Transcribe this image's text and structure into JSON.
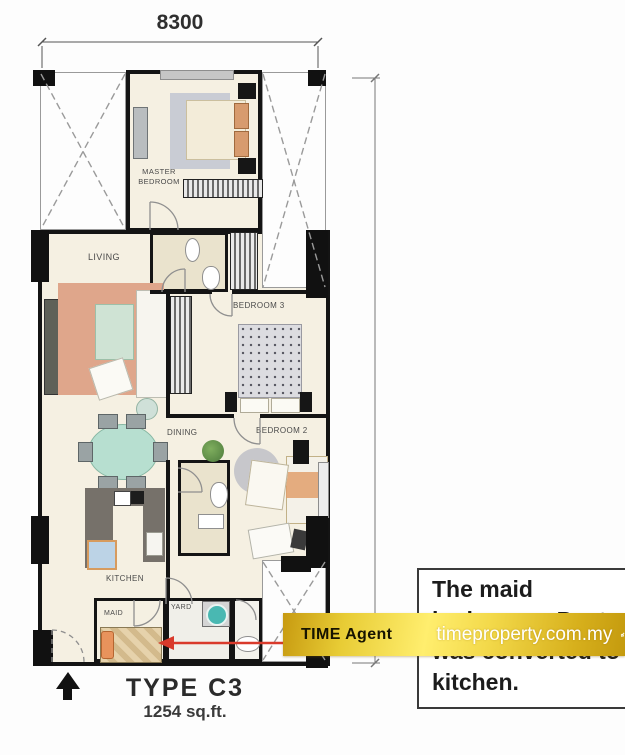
{
  "floor_plan": {
    "top_dimension": "8300",
    "unit_type": "TYPE C3",
    "unit_area": "1254 sq.ft.",
    "room_labels": {
      "master_bedroom": "MASTER BEDROOM",
      "living": "LIVING",
      "bedroom3": "BEDROOM 3",
      "dining": "DINING",
      "bedroom2": "BEDROOM 2",
      "kitchen": "KITCHEN",
      "maid": "MAID",
      "yard": "YARD"
    }
  },
  "note_box": {
    "lines": [
      "The maid",
      "bedroom + Pantry",
      "was converted to",
      "kitchen."
    ]
  },
  "banner": {
    "agent_label": "TIME Agent",
    "website": "timeproperty.com.my"
  },
  "colors": {
    "banner_gold": "#e8c52e",
    "arrow_red": "#d93a2b",
    "wall": "#141414",
    "floor_cream": "#f5f0e2",
    "rug_salmon": "#dfa68b",
    "table_mint": "#b7dfd0",
    "appliance_teal": "#49b8b2"
  }
}
